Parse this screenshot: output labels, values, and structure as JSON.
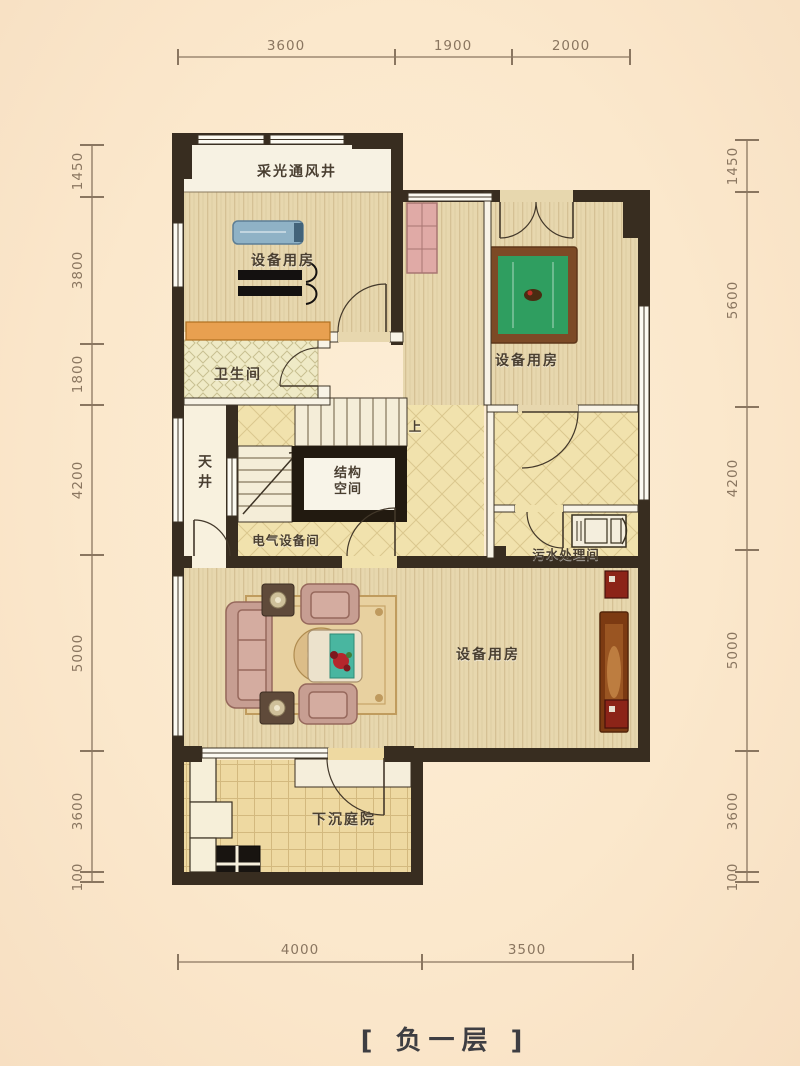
{
  "title": "[ 负一层 ]",
  "rooms": {
    "shaft": "采光通风井",
    "gym": "设备用房",
    "bathroom": "卫生间",
    "lightwell": "天井",
    "structure_line1": "结构",
    "structure_line2": "空间",
    "electrical": "电气设备间",
    "sewage": "污水处理间",
    "billiard_room": "设备用房",
    "living": "设备用房",
    "courtyard": "下沉庭院",
    "stairs_up": "上"
  },
  "dimensions": {
    "top": [
      "3600",
      "1900",
      "2000"
    ],
    "bottom": [
      "4000",
      "3500"
    ],
    "left": [
      "1450",
      "3800",
      "1800",
      "4200",
      "5000",
      "3600",
      "100"
    ],
    "right": [
      "1450",
      "5600",
      "4200",
      "5000",
      "3600",
      "100"
    ]
  },
  "colors": {
    "background": "#fbe8cc",
    "wall": "#382d20",
    "wood_floor": "#e7d7ae",
    "tile_floor": "#f1e2ad",
    "counter": "#e8a050",
    "billiard_felt": "#2f9e60",
    "sofa": "#c79e92",
    "dimension_text": "#8a7660",
    "label_text": "#4a3f30"
  }
}
